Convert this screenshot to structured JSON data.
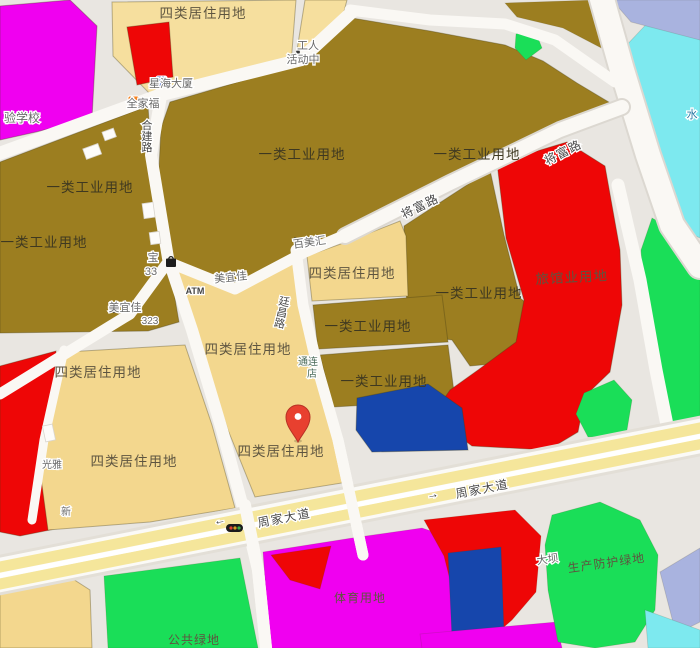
{
  "map": {
    "zone_labels": {
      "residential4": "四类居住用地",
      "industrial1": "一类工业用地",
      "hotel": "旅馆业用地",
      "sports": "体育用地",
      "public_green": "公共绿地",
      "protective_green": "生产防护绿地"
    },
    "road_labels": {
      "jiangfu": "将富路",
      "zhoujia": "周家大道",
      "hejian": "合建路",
      "tingchang": "廷昌路"
    },
    "arrows": {
      "left": "←",
      "right": "→"
    },
    "pois": {
      "school": "验学校",
      "xinghai_tower": "星海大厦",
      "quanjiafu": "全家福",
      "worker_center_line1": "工人",
      "worker_center_line2": "活动中",
      "bao": "宝",
      "num_33": "33",
      "atm": "ATM",
      "meiyijia": "美宜佳",
      "num_323": "323",
      "baimeihui": "百美汇",
      "tonglian_line1": "通连",
      "tonglian_line2": "店",
      "guangya": "光雅",
      "xin": "新",
      "water": "水",
      "daba": "大坝"
    },
    "colors": {
      "residential": "#F3D78E",
      "residential_light": "#F6DF9E",
      "industrial": "#9C7E20",
      "red_zone": "#EE0606",
      "magenta_zone": "#F000F0",
      "green_zone": "#1ADE58",
      "blue_zone": "#1646AC",
      "water": "#7DE9EF",
      "periwinkle": "#A9B3DF",
      "hotel_text": "#A50D0D",
      "sports_text": "#B503B5",
      "green_text": "#48735A",
      "road_yellow": "#F5E69B",
      "pin_red": "#E8402F"
    }
  }
}
